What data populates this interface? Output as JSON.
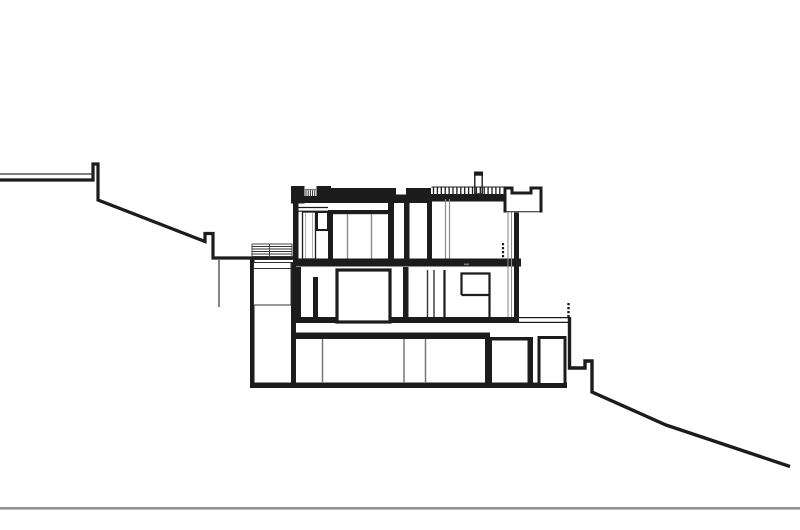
{
  "canvas": {
    "width": 800,
    "height": 530,
    "background": "#ffffff"
  },
  "palette": {
    "main": "#1c1c1c",
    "thin": "#333333",
    "muted": "#8c8c8c",
    "faint": "#aaaaaa",
    "soft": "#777777",
    "ground": "#909090",
    "white": "#ffffff"
  },
  "drawing": {
    "rects": [
      {
        "name": "site-baseline",
        "x": 0,
        "y": 507,
        "w": 800,
        "h": 2.6,
        "color": "ground"
      },
      {
        "name": "left-retaining-wall",
        "x": 250,
        "y": 258,
        "w": 4.5,
        "h": 128.5,
        "color": "main"
      },
      {
        "name": "left-room-right-wall",
        "x": 291,
        "y": 262,
        "w": 5,
        "h": 124.5,
        "color": "main"
      },
      {
        "name": "foundation-slab",
        "x": 250,
        "y": 382.5,
        "w": 317,
        "h": 5.5,
        "color": "main"
      },
      {
        "name": "lower-floor-slab",
        "x": 291,
        "y": 332.5,
        "w": 199,
        "h": 6.5,
        "color": "main"
      },
      {
        "name": "basement-room1-left-wall",
        "x": 485,
        "y": 337,
        "w": 7,
        "h": 47,
        "color": "main"
      },
      {
        "name": "basement-room1-right-wall",
        "x": 527.5,
        "y": 337,
        "w": 5.5,
        "h": 47,
        "color": "main"
      },
      {
        "name": "basement-room1-top-edge",
        "x": 485,
        "y": 337,
        "w": 48,
        "h": 3.5,
        "color": "main"
      },
      {
        "name": "middle-floor-slab",
        "x": 296,
        "y": 317,
        "w": 222,
        "h": 6,
        "color": "main"
      },
      {
        "name": "pocket-wall-left",
        "x": 296,
        "y": 267,
        "w": 5,
        "h": 55,
        "color": "main"
      },
      {
        "name": "pocket-wall-bottom",
        "x": 296,
        "y": 317,
        "w": 22,
        "h": 5.5,
        "color": "main"
      },
      {
        "name": "pocket-wall-right",
        "x": 313,
        "y": 277,
        "w": 5,
        "h": 45,
        "color": "main"
      },
      {
        "name": "middle-floor-wall",
        "x": 403,
        "y": 267,
        "w": 5.5,
        "h": 55,
        "color": "main"
      },
      {
        "name": "right-facade-wall",
        "x": 514,
        "y": 212,
        "w": 5,
        "h": 110,
        "color": "main"
      },
      {
        "name": "upper-floor-slab",
        "x": 293,
        "y": 258.5,
        "w": 228,
        "h": 8,
        "color": "main"
      },
      {
        "name": "upper-left-wall",
        "x": 293,
        "y": 203,
        "w": 5.5,
        "h": 56,
        "color": "main"
      },
      {
        "name": "left-parapet-block",
        "x": 291,
        "y": 186,
        "w": 13.5,
        "h": 17.5,
        "color": "main"
      },
      {
        "name": "roof-slab-under-ticks",
        "x": 304.5,
        "y": 196,
        "w": 26.5,
        "h": 7,
        "color": "main"
      },
      {
        "name": "roof-parapet-block-b",
        "x": 316.5,
        "y": 186,
        "w": 14.5,
        "h": 10.5,
        "color": "main"
      },
      {
        "name": "roof-raised-slab-left",
        "x": 331,
        "y": 188,
        "w": 65,
        "h": 15,
        "color": "main"
      },
      {
        "name": "roof-slab-dip",
        "x": 396,
        "y": 194.5,
        "w": 10,
        "h": 8.5,
        "color": "main"
      },
      {
        "name": "roof-raised-slab-right",
        "x": 406,
        "y": 188,
        "w": 25,
        "h": 15,
        "color": "main"
      },
      {
        "name": "roof-terrace-slab",
        "x": 431,
        "y": 194,
        "w": 74.5,
        "h": 7.5,
        "color": "main"
      },
      {
        "name": "chimney-cap",
        "x": 474,
        "y": 171.5,
        "w": 9,
        "h": 4.5,
        "color": "main"
      },
      {
        "name": "upper-room1-left-wall",
        "x": 328,
        "y": 210,
        "w": 5,
        "h": 53,
        "color": "main"
      },
      {
        "name": "upper-room1-lintel-bar",
        "x": 328,
        "y": 210,
        "w": 66,
        "h": 4.2,
        "color": "main"
      },
      {
        "name": "upper-room1-right-wall",
        "x": 388,
        "y": 202.5,
        "w": 6,
        "h": 60.5,
        "color": "main"
      },
      {
        "name": "upper-room2-left-wall",
        "x": 404,
        "y": 198.5,
        "w": 5.5,
        "h": 64.5,
        "color": "main"
      },
      {
        "name": "upper-room2-mid-wall",
        "x": 427,
        "y": 198.5,
        "w": 5,
        "h": 64.5,
        "color": "main"
      },
      {
        "name": "dimension-mark",
        "x": 464,
        "y": 263.5,
        "w": 5,
        "h": 1.6,
        "color": "soft"
      }
    ],
    "outlined": [
      {
        "name": "planter-box",
        "x": 253.5,
        "y": 262.5,
        "w": 37.5,
        "h": 42.5,
        "sw": 1,
        "color": "thin"
      },
      {
        "name": "entry-stairs-frame",
        "x": 252,
        "y": 244,
        "w": 40,
        "h": 15.5,
        "sw": 0.9,
        "color": "thin"
      },
      {
        "name": "middle-room-window",
        "x": 337,
        "y": 270,
        "w": 53,
        "h": 52,
        "sw": 3.2,
        "color": "main"
      },
      {
        "name": "basement-room2",
        "x": 539,
        "y": 337.5,
        "w": 26,
        "h": 47,
        "sw": 3,
        "color": "main"
      },
      {
        "name": "upper-door-shaft",
        "x": 302.5,
        "y": 212,
        "w": 13,
        "h": 47,
        "sw": 1.3,
        "color": "main"
      },
      {
        "name": "upper-wall-stub",
        "x": 317,
        "y": 212,
        "w": 11,
        "h": 18,
        "sw": 2,
        "color": "main"
      },
      {
        "name": "chimney-body",
        "x": 474.8,
        "y": 175,
        "w": 7.4,
        "h": 19,
        "sw": 1.4,
        "color": "main"
      }
    ],
    "paths": [
      {
        "name": "terrain-uphill",
        "d": "M0,180 H93 V164 H98 V200 L205,241.5 V233.5 H213 V258 H296",
        "sw": 3.2,
        "color": "main",
        "fill": "none"
      },
      {
        "name": "terrain-downhill",
        "d": "M569.5,317 V368 H585 V361 H592 V392 L666,425 L790,466.5",
        "sw": 3.4,
        "color": "main",
        "fill": "none"
      },
      {
        "name": "right-roof-parapet",
        "d": "M505,212.5 V188 H512 V193 H531 V188 H541 V212.5",
        "sw": 3,
        "color": "main",
        "fill": "white"
      },
      {
        "name": "middle-window-nook",
        "d": "M461.5,295 V273.5 H489.5 V322 M461.5,295 H489.5",
        "sw": 2.2,
        "color": "main",
        "fill": "none"
      }
    ],
    "lines": [
      {
        "name": "uphill-terrain-thin-line",
        "x1": 0,
        "y1": 174,
        "x2": 93,
        "y2": 174,
        "sw": 1.2,
        "color": "thin"
      },
      {
        "name": "underground-cut-line",
        "x1": 219,
        "y1": 260,
        "x2": 219,
        "y2": 307,
        "sw": 1.2,
        "color": "thin"
      },
      {
        "name": "planter-rim-line",
        "x1": 253.5,
        "y1": 268.5,
        "x2": 291,
        "y2": 268.5,
        "sw": 1,
        "color": "thin"
      },
      {
        "name": "stair-tread-1",
        "x1": 252,
        "y1": 246.5,
        "x2": 292,
        "y2": 246.5,
        "sw": 0.9,
        "color": "thin"
      },
      {
        "name": "stair-tread-2",
        "x1": 252,
        "y1": 249,
        "x2": 292,
        "y2": 249,
        "sw": 0.9,
        "color": "thin"
      },
      {
        "name": "stair-tread-3",
        "x1": 252,
        "y1": 251.5,
        "x2": 292,
        "y2": 251.5,
        "sw": 0.9,
        "color": "thin"
      },
      {
        "name": "stair-tread-4",
        "x1": 252,
        "y1": 254,
        "x2": 292,
        "y2": 254,
        "sw": 0.9,
        "color": "thin"
      },
      {
        "name": "stair-tread-5",
        "x1": 252,
        "y1": 256.5,
        "x2": 292,
        "y2": 256.5,
        "sw": 0.9,
        "color": "thin"
      },
      {
        "name": "stair-mid-stringer",
        "x1": 269.5,
        "y1": 244,
        "x2": 269.5,
        "y2": 259,
        "sw": 0.9,
        "color": "thin"
      },
      {
        "name": "door-lintel-upper",
        "x1": 298.5,
        "y1": 207.5,
        "x2": 328,
        "y2": 207.5,
        "sw": 1.2,
        "color": "main"
      },
      {
        "name": "door-lintel-lower",
        "x1": 298.5,
        "y1": 211.2,
        "x2": 328,
        "y2": 211.2,
        "sw": 1.2,
        "color": "main"
      },
      {
        "name": "door-shaft-inner-1",
        "x1": 305.5,
        "y1": 213,
        "x2": 305.5,
        "y2": 258,
        "sw": 0.9,
        "color": "faint"
      },
      {
        "name": "door-shaft-inner-2",
        "x1": 312.5,
        "y1": 213,
        "x2": 312.5,
        "y2": 258,
        "sw": 0.9,
        "color": "faint"
      },
      {
        "name": "upper-room1-mullion-1",
        "x1": 347.5,
        "y1": 214,
        "x2": 347.5,
        "y2": 258.5,
        "sw": 1.4,
        "color": "muted"
      },
      {
        "name": "upper-room1-mullion-2",
        "x1": 371.5,
        "y1": 214,
        "x2": 371.5,
        "y2": 258.5,
        "sw": 1.4,
        "color": "muted"
      },
      {
        "name": "upper-room2-glazing-1",
        "x1": 445.5,
        "y1": 199,
        "x2": 445.5,
        "y2": 258.5,
        "sw": 1.2,
        "color": "muted"
      },
      {
        "name": "upper-room2-glazing-2",
        "x1": 449.5,
        "y1": 199,
        "x2": 449.5,
        "y2": 258.5,
        "sw": 1.2,
        "color": "muted"
      },
      {
        "name": "roof-railing-top-rail",
        "x1": 431.5,
        "y1": 187,
        "x2": 504,
        "y2": 187,
        "sw": 1,
        "color": "main"
      },
      {
        "name": "roof-ticks-top-rail",
        "x1": 305,
        "y1": 189.8,
        "x2": 316,
        "y2": 189.8,
        "sw": 0.8,
        "color": "main"
      },
      {
        "name": "right-wall-liner-1",
        "x1": 508,
        "y1": 212,
        "x2": 508,
        "y2": 317,
        "sw": 1.1,
        "color": "muted"
      },
      {
        "name": "right-wall-liner-2",
        "x1": 511.5,
        "y1": 212,
        "x2": 511.5,
        "y2": 317,
        "sw": 1.1,
        "color": "muted"
      },
      {
        "name": "middle-floor-mullion-1",
        "x1": 427.5,
        "y1": 270,
        "x2": 427.5,
        "y2": 317,
        "sw": 1.4,
        "color": "thin"
      },
      {
        "name": "middle-floor-mullion-2",
        "x1": 434,
        "y1": 270,
        "x2": 434,
        "y2": 317,
        "sw": 1.4,
        "color": "thin"
      },
      {
        "name": "middle-floor-post",
        "x1": 444.5,
        "y1": 270,
        "x2": 444.5,
        "y2": 317,
        "sw": 2.2,
        "color": "main"
      },
      {
        "name": "basement-partition-1",
        "x1": 322.5,
        "y1": 339,
        "x2": 322.5,
        "y2": 383,
        "sw": 1.5,
        "color": "soft"
      },
      {
        "name": "basement-partition-2",
        "x1": 404,
        "y1": 339,
        "x2": 404,
        "y2": 383,
        "sw": 1.5,
        "color": "soft"
      },
      {
        "name": "basement-partition-3",
        "x1": 425.5,
        "y1": 339,
        "x2": 425.5,
        "y2": 383,
        "sw": 1.5,
        "color": "soft"
      },
      {
        "name": "terrace-slab-top-line",
        "x1": 518,
        "y1": 317.6,
        "x2": 569.5,
        "y2": 317.6,
        "sw": 1.2,
        "color": "main"
      },
      {
        "name": "terrace-slab-bottom-line",
        "x1": 518,
        "y1": 322.4,
        "x2": 569.5,
        "y2": 322.4,
        "sw": 1.2,
        "color": "main"
      },
      {
        "name": "right-parapet-base-line",
        "x1": 505,
        "y1": 211.8,
        "x2": 541,
        "y2": 211.8,
        "sw": 1,
        "color": "main"
      }
    ],
    "dashed": [
      {
        "name": "interior-guardrail-dashed",
        "x1": 503,
        "y1": 243,
        "x2": 503,
        "y2": 260,
        "sw": 2.2,
        "dash": "2.2,1.8",
        "color": "main"
      },
      {
        "name": "terrace-guardrail-dashed",
        "x1": 568.5,
        "y1": 303,
        "x2": 568.5,
        "y2": 318,
        "sw": 2.4,
        "dash": "2.2,1.8",
        "color": "main"
      }
    ],
    "ticks": [
      {
        "name": "roof-railing-balusters",
        "x_start": 433.5,
        "x_end": 503.5,
        "step": 3.9,
        "y1": 187,
        "y2": 194,
        "sw": 1.3,
        "color": "main"
      },
      {
        "name": "roof-vent-fins",
        "x_start": 306,
        "x_end": 315.2,
        "step": 2.2,
        "y1": 190.5,
        "y2": 196,
        "sw": 0.9,
        "color": "main"
      }
    ]
  }
}
